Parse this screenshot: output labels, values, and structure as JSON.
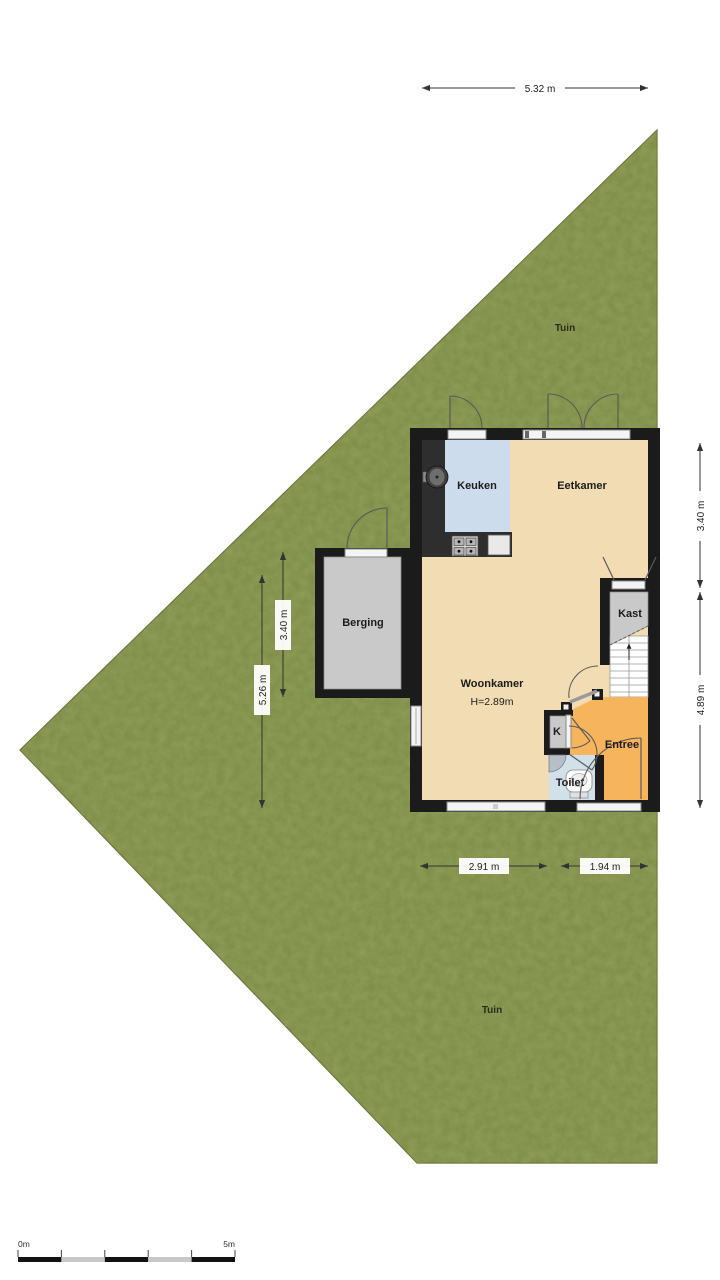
{
  "rooms": {
    "tuin_top": "Tuin",
    "tuin_bottom": "Tuin",
    "keuken": "Keuken",
    "eetkamer": "Eetkamer",
    "berging": "Berging",
    "woonkamer": "Woonkamer",
    "woonkamer_height": "H=2.89m",
    "kast": "Kast",
    "meterkast": "K",
    "entree": "Entree",
    "toilet": "Toilet"
  },
  "dimensions": {
    "top": "5.32 m",
    "right_upper": "3.40 m",
    "right_lower": "4.89 m",
    "left_outer": "5.26 m",
    "left_inner": "3.40 m",
    "bottom_left": "2.91 m",
    "bottom_right": "1.94 m"
  },
  "scale_bar": {
    "start": "0m",
    "end": "5m"
  },
  "colors": {
    "garden": "#7a8b42",
    "garden_edge": "#5f6e33",
    "wall": "#1b1b1b",
    "floor_living": "#f1dcb3",
    "floor_kitchen": "#cddced",
    "floor_entree": "#f6b45c",
    "floor_storage": "#c9c9c9",
    "floor_toilet": "#d2e0ea",
    "counter": "#2e2e2e",
    "dimension_line": "#333333"
  }
}
